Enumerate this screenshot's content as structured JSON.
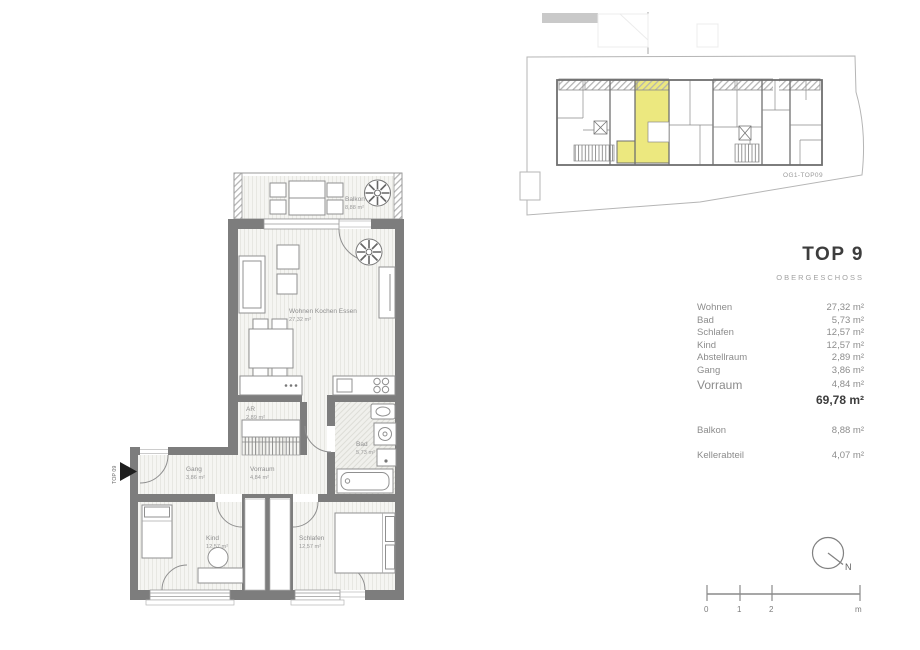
{
  "title_panel": {
    "title": "TOP 9",
    "subtitle": "OBERGESCHOSS",
    "rooms": [
      {
        "name": "Wohnen",
        "area": "27,32 m²"
      },
      {
        "name": "Bad",
        "area": "5,73 m²"
      },
      {
        "name": "Schlafen",
        "area": "12,57 m²"
      },
      {
        "name": "Kind",
        "area": "12,57 m²"
      },
      {
        "name": "Abstellraum",
        "area": "2,89 m²"
      },
      {
        "name": "Gang",
        "area": "3,86 m²"
      },
      {
        "name": "Vorraum",
        "area": "4,84 m²"
      }
    ],
    "total_area": "69,78 m²",
    "extras": [
      {
        "name": "Balkon",
        "area": "8,88 m²"
      },
      {
        "name": "Kellerabteil",
        "area": "4,07 m²"
      }
    ]
  },
  "plan": {
    "balkon": {
      "name": "Balkon",
      "area": "8,88 m²"
    },
    "wohnen": {
      "name": "Wohnen Kochen Essen",
      "area": "27,32 m²"
    },
    "ar": {
      "name": "AR",
      "area": "2,89 m²"
    },
    "gang": {
      "name": "Gang",
      "area": "3,86 m²"
    },
    "vorraum": {
      "name": "Vorraum",
      "area": "4,84 m²"
    },
    "bad": {
      "name": "Bad",
      "area": "5,73 m²"
    },
    "kind": {
      "name": "Kind",
      "area": "12,57 m²"
    },
    "schlafen": {
      "name": "Schlafen",
      "area": "12,57 m²"
    },
    "entrance_label": "TOP 09"
  },
  "overview": {
    "label": "OG1-TOP09"
  },
  "scale_bar": {
    "ticks": [
      "0",
      "1",
      "2",
      "m"
    ]
  },
  "north": {
    "label": "N"
  },
  "colors": {
    "wall": "#7d7d7d",
    "highlight": "#ece87f",
    "text": "#8f8f8f",
    "title": "#3d3d3d"
  }
}
